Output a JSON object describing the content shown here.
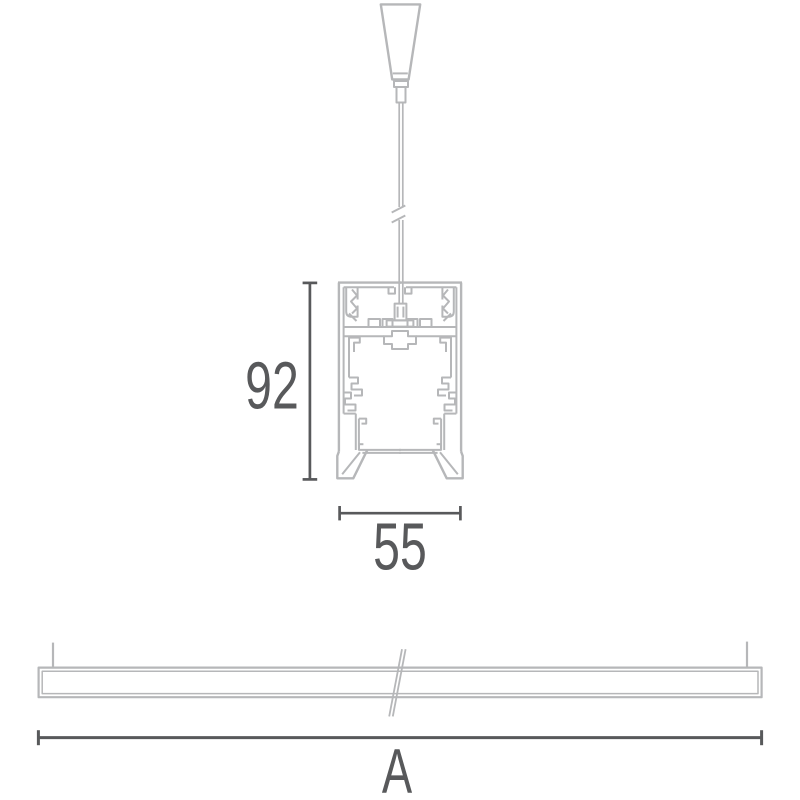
{
  "drawing": {
    "dimensions": {
      "profile_height_mm": "92",
      "profile_width_mm": "55",
      "fixture_length_label": "A"
    },
    "colors": {
      "outline": "#b6b7b9",
      "dimension": "#58595b",
      "background": "#ffffff"
    }
  }
}
